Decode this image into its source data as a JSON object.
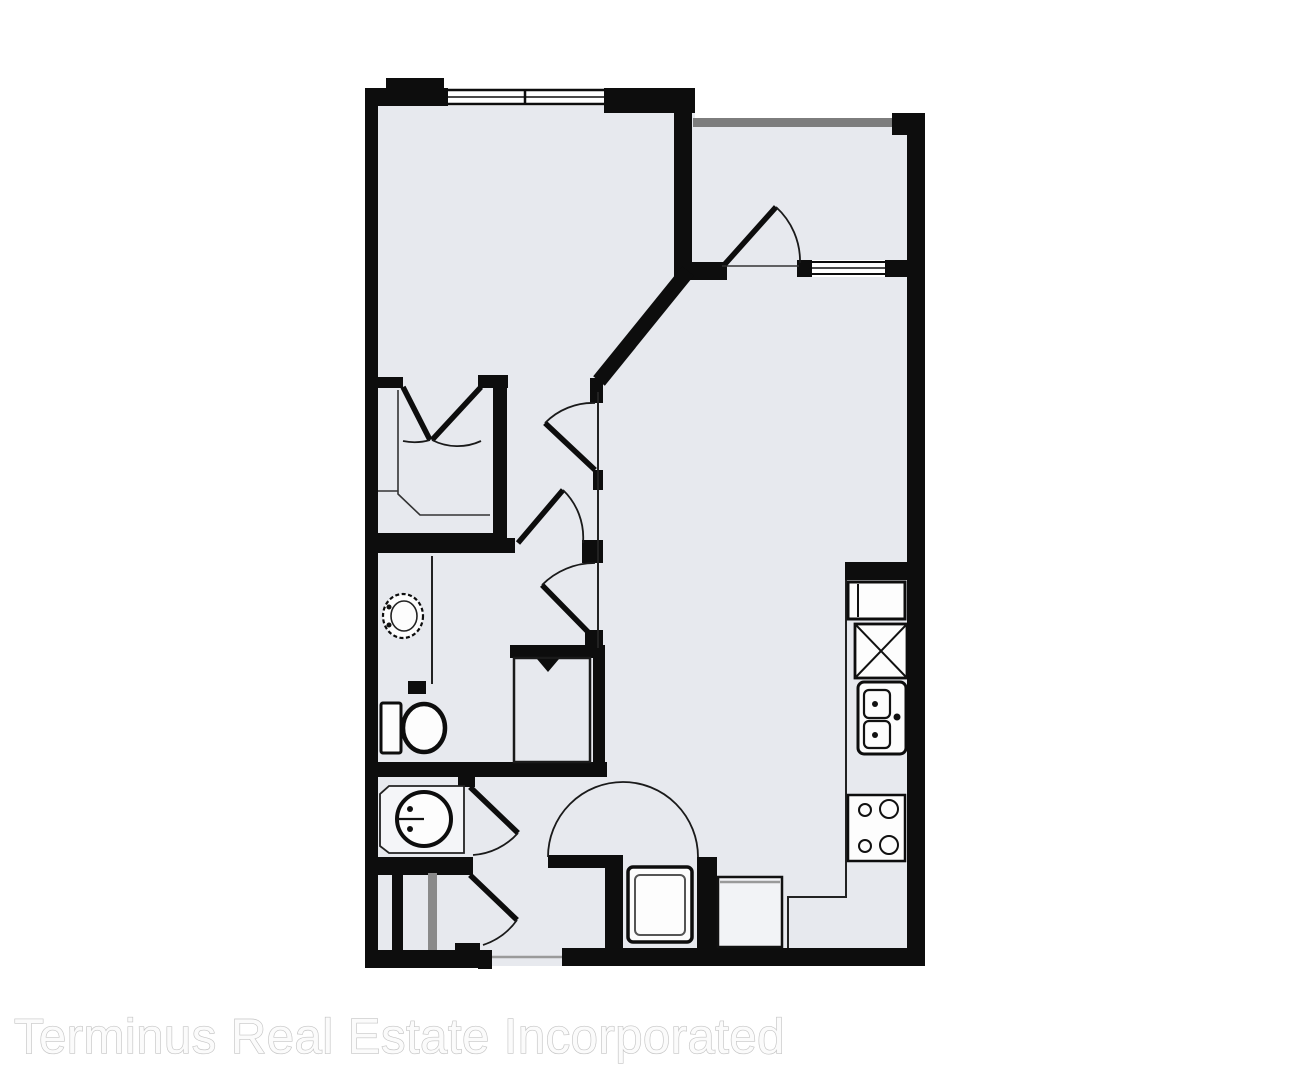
{
  "watermark": {
    "text": "Terminus Real Estate Incorporated"
  },
  "colors": {
    "background": "#ffffff",
    "floor_fill": "#e7e9ee",
    "wall": "#0d0d0d",
    "fixture_fill": "#fdfdfd",
    "accent_gray": "#7d7d7d",
    "shadow_gray": "#9a9a9a",
    "watermark_fill": "#fbfbfb",
    "watermark_stroke": "#c4c4c4"
  },
  "floorplan": {
    "type": "apartment-unit-floor-plan",
    "rooms": [
      "bedroom",
      "walk-in-closet",
      "bathroom",
      "half-bath",
      "linen-closet",
      "hallway",
      "living-room",
      "kitchen",
      "balcony",
      "entry"
    ],
    "fixtures": [
      "bedroom-window",
      "balcony-window",
      "balcony-door",
      "bedroom-door",
      "bathroom-doors",
      "closet-double-doors",
      "toilet",
      "bathroom-sink",
      "halfbath-sink",
      "washer-dryer-closet",
      "refrigerator",
      "pantry-x-cabinet",
      "kitchen-sink",
      "stove",
      "water-heater",
      "pantry-cabinet",
      "entry-door-swing"
    ]
  }
}
